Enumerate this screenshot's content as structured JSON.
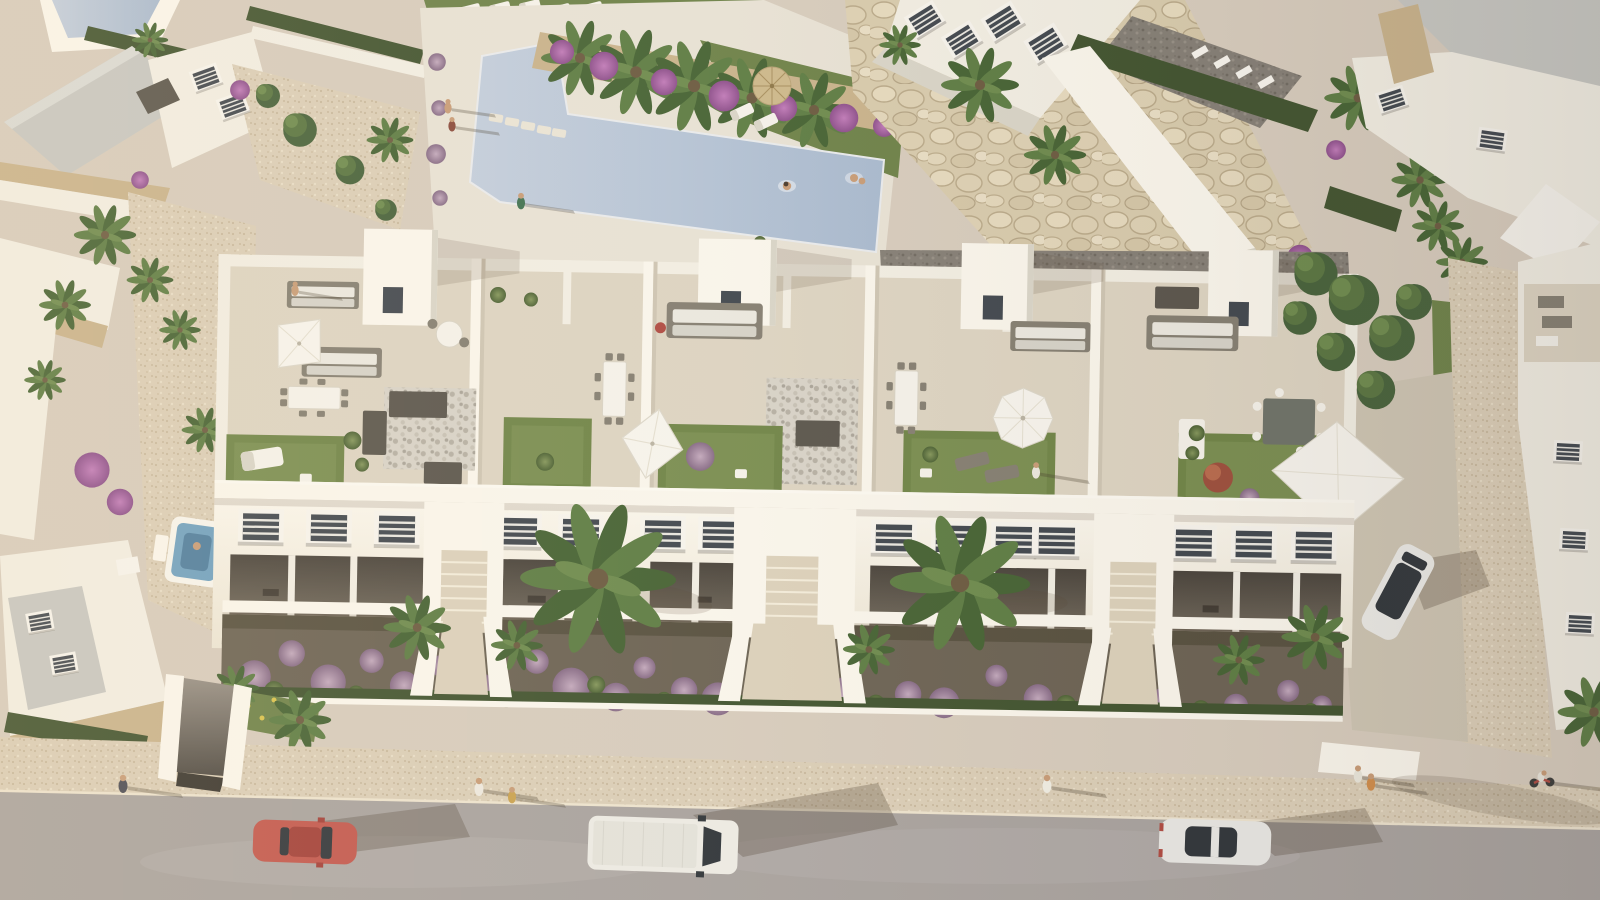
{
  "image": {
    "kind": "aerial architectural 3d render",
    "alt": "Aerial view of a white Mediterranean apartment building with rooftop terraces (lawns, umbrellas, sofas, dining sets), a communal swimming pool with rock wall, villas, palm gardens with purple flowering bushes, and a street with a red car, white van, white sedan, parked SUV, cyclist and pedestrians casting long evening shadows.",
    "people_count": 16,
    "vehicle_count": 5
  },
  "palette": {
    "ground": "#d6cbbc",
    "road": "#a8a29e",
    "road_light": "#b3adaa",
    "sidewalk": "#dacdb6",
    "sidewalk_dot": "#c7b79c",
    "wall": "#f1ede2",
    "wall_lit": "#f9f5eb",
    "wall_shade": "#d8d4c7",
    "wall_grad_bottom": "#ebe4d3",
    "roof_gray": "#c6c6c1",
    "tile": "#dcd3c1",
    "tile_shade": "#cdc4b2",
    "stone": "#c8b28b",
    "deck": "#e7e1d4",
    "pool": "#c2cddc",
    "pool_deep": "#a8b9ce",
    "spa": "#6fa0bf",
    "spa_deep": "#4e7d9e",
    "lawn": "#6f8447",
    "lawn_light": "#85985a",
    "grass": "#6d8148",
    "hedge": "#41532f",
    "soil": "#6b6253",
    "tree": "#587440",
    "tree_dark": "#46613a",
    "tree_light": "#6d8a4d",
    "palm": "#5d7c43",
    "palm_dark": "#456233",
    "pergola": "#5a554c",
    "sofa": "#847e71",
    "cushion": "#eae7de",
    "furniture_white": "#f4f1e9",
    "umbrella_white": "#f6f3ec",
    "window_glass": "#41474e",
    "car_glass": "#30353a",
    "car_red": "#c2574d",
    "car_red_dark": "#a23f38",
    "van_white": "#eceae3",
    "van_roof": "#e3e1d9",
    "sedan_white": "#e7e6e2",
    "suv_white": "#eae9e5",
    "straw": "#ccb88b",
    "straw_dark": "#a78e5e",
    "skin": "#c79b76",
    "bloom_purple": "#a88ba6",
    "bloom_purple_dark": "#866a85",
    "bougainvillea": "#a765a3",
    "bougainvillea_dark": "#8d4f8b",
    "flower_red": "#ae4a41",
    "flower_yellow": "#d9c24d",
    "rock": "#d7caac",
    "rock_light": "#e5d9bd",
    "rock_shadow": "#b7a788",
    "pebble_base": "#d7d2c7",
    "pebble_dot": "#b5afa3",
    "gravel": "#847e75",
    "gravel_dot": "#6f6960",
    "loggia_top": "#49433b",
    "loggia_bottom": "#6f675a",
    "ramp_top": "#978f85",
    "ramp_bottom": "#4f4a43",
    "steps": "#dbd0ba",
    "steps_line": "#f2ebd9"
  },
  "scene": {
    "pool": {
      "name": "swimming-pool",
      "swimmers": 2
    },
    "vehicles": [
      {
        "name": "red-car",
        "body": "#c2574d",
        "state": "driving"
      },
      {
        "name": "white-van",
        "body": "#eceae3",
        "state": "driving"
      },
      {
        "name": "white-sedan",
        "body": "#e7e6e2",
        "state": "driving"
      },
      {
        "name": "parked-suv",
        "body": "#eae9e5",
        "state": "parked"
      },
      {
        "name": "bicycle",
        "body": "#ae4a41",
        "state": "riding"
      }
    ],
    "roof_terrace_units": 5,
    "roof_features": [
      "lawn",
      "white-umbrella",
      "sail-shade",
      "dining-set",
      "sofa-set",
      "pergola",
      "pebble-patch",
      "sun-lounger"
    ],
    "landscape": [
      "palm-trees",
      "purple-flower-bushes",
      "bougainvillea",
      "hedges",
      "rock-retaining-wall",
      "gravel-paths",
      "jacuzzi"
    ]
  }
}
